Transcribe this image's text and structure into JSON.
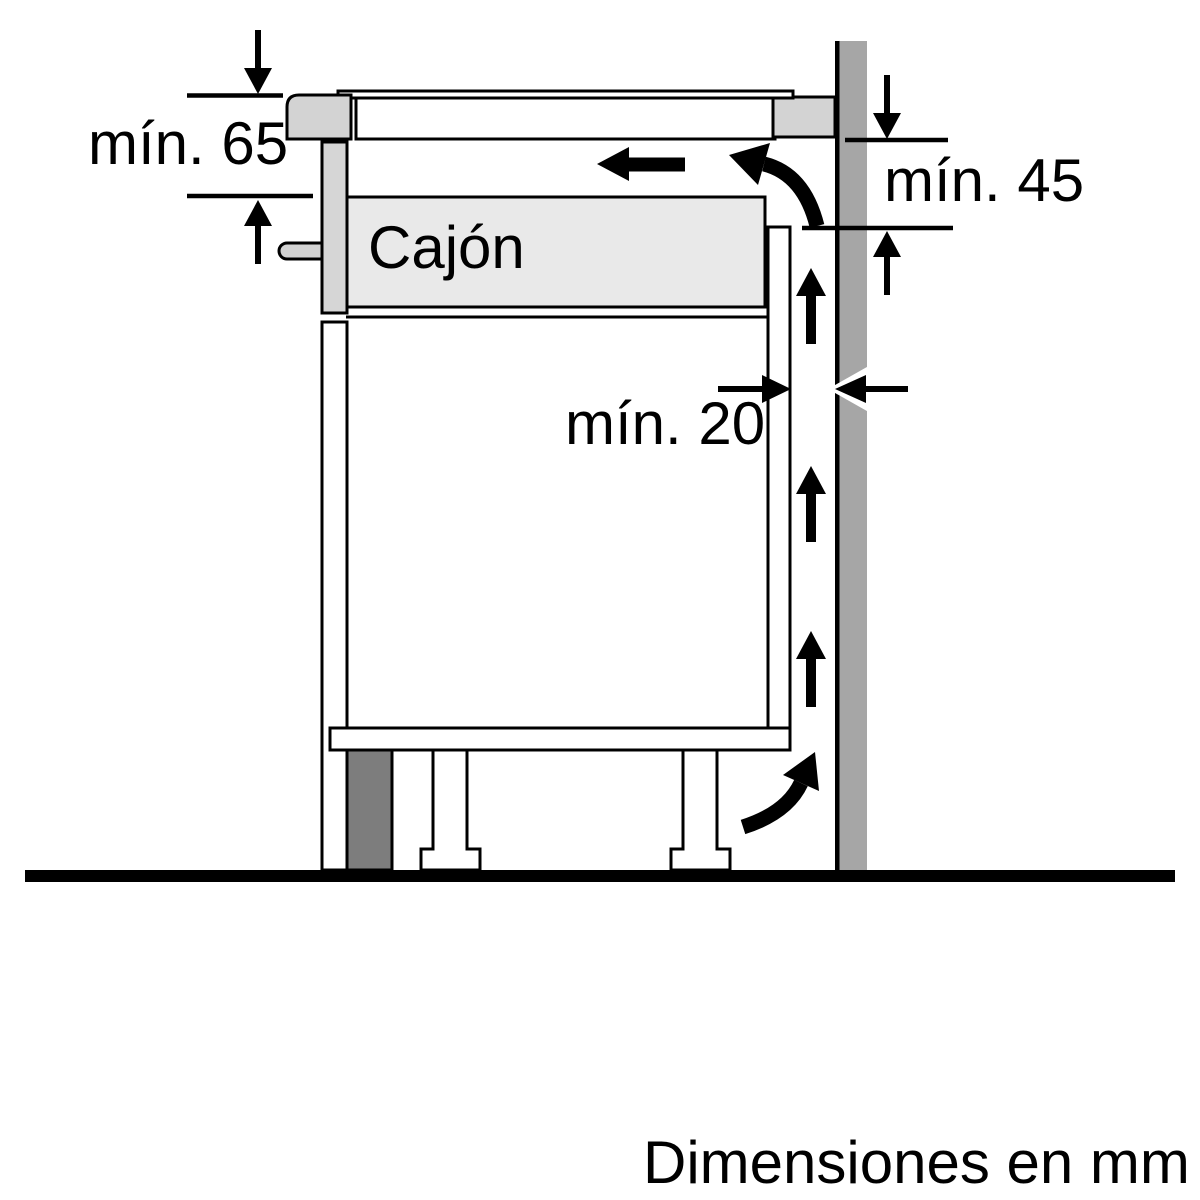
{
  "diagram": {
    "footer_note": "Dimensiones en mm",
    "drawer_label": "Cajón",
    "dim_min65": "mín. 65",
    "dim_min45": "mín. 45",
    "dim_min20": "mín. 20",
    "colors": {
      "wall_gray": "#a6a6a6",
      "worktop_gray": "#d3d3d3",
      "drawer_front_gray": "#d6d6d6",
      "drawer_box_gray": "#e9e9e9",
      "plinth_gray": "#7d7d7d",
      "arrow_black": "#000000",
      "panel_white": "#ffffff"
    }
  }
}
